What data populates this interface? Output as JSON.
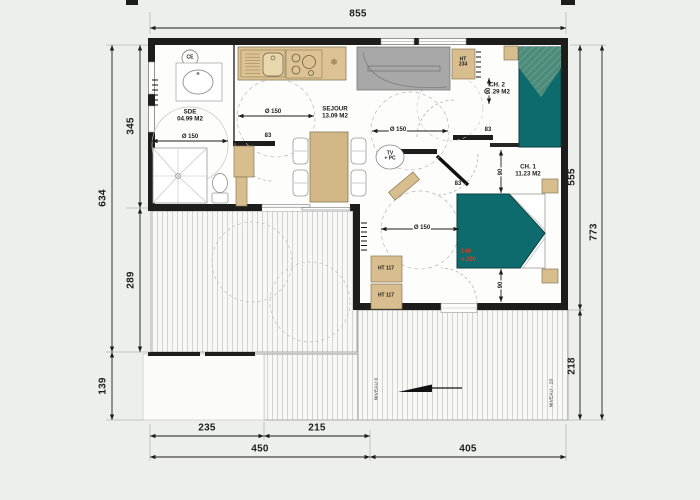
{
  "plan": {
    "dimensions": {
      "top_width": "855",
      "left_total": "634",
      "left_step": "139",
      "left_upper": "345",
      "left_deck": "289",
      "right_building": "555",
      "right_deck": "218",
      "right_total": "773",
      "bottom_step": "235",
      "bottom_deck": "215",
      "bottom_left_total": "450",
      "bottom_right_total": "405"
    },
    "rooms": {
      "sde": {
        "name": "SDE",
        "area": "04.99 M2"
      },
      "sejour": {
        "name": "SEJOUR",
        "area": "13.09 M2"
      },
      "ch2": {
        "name": "CH. 2",
        "area": "04.29 M2"
      },
      "ch1": {
        "name": "CH. 1",
        "area": "11.23 M2"
      }
    },
    "fixtures": {
      "water_heater": "CE",
      "tv_line1": "TV",
      "tv_line2": "+ PC",
      "tall_cabinet_line1": "HT",
      "tall_cabinet_line2": "234",
      "cabinet_1": "HT 117",
      "cabinet_2": "HT 117",
      "fridge_icon": "❄"
    },
    "bed": {
      "size_line1": "140",
      "size_line2": "x 200"
    },
    "clearances": {
      "sde": "Ø 150",
      "sejour_left": "Ø 150",
      "sejour_right": "Ø 150",
      "ch1": "Ø 150",
      "door_sde": "83",
      "door_ch2": "83",
      "door_ch1": "83",
      "gap_sofa": "90",
      "gap_bed_top": "90",
      "gap_bed_bottom": "90"
    },
    "levels": {
      "deck": "NIVEAU 0",
      "lower_deck": "NIVEAU - 20"
    },
    "colors": {
      "wall": "#1d1d1b",
      "wood": "#d8bd8e",
      "bed": "#0e6b6d",
      "sofa": "#a8a8a8",
      "accent": "#cc4125"
    }
  }
}
